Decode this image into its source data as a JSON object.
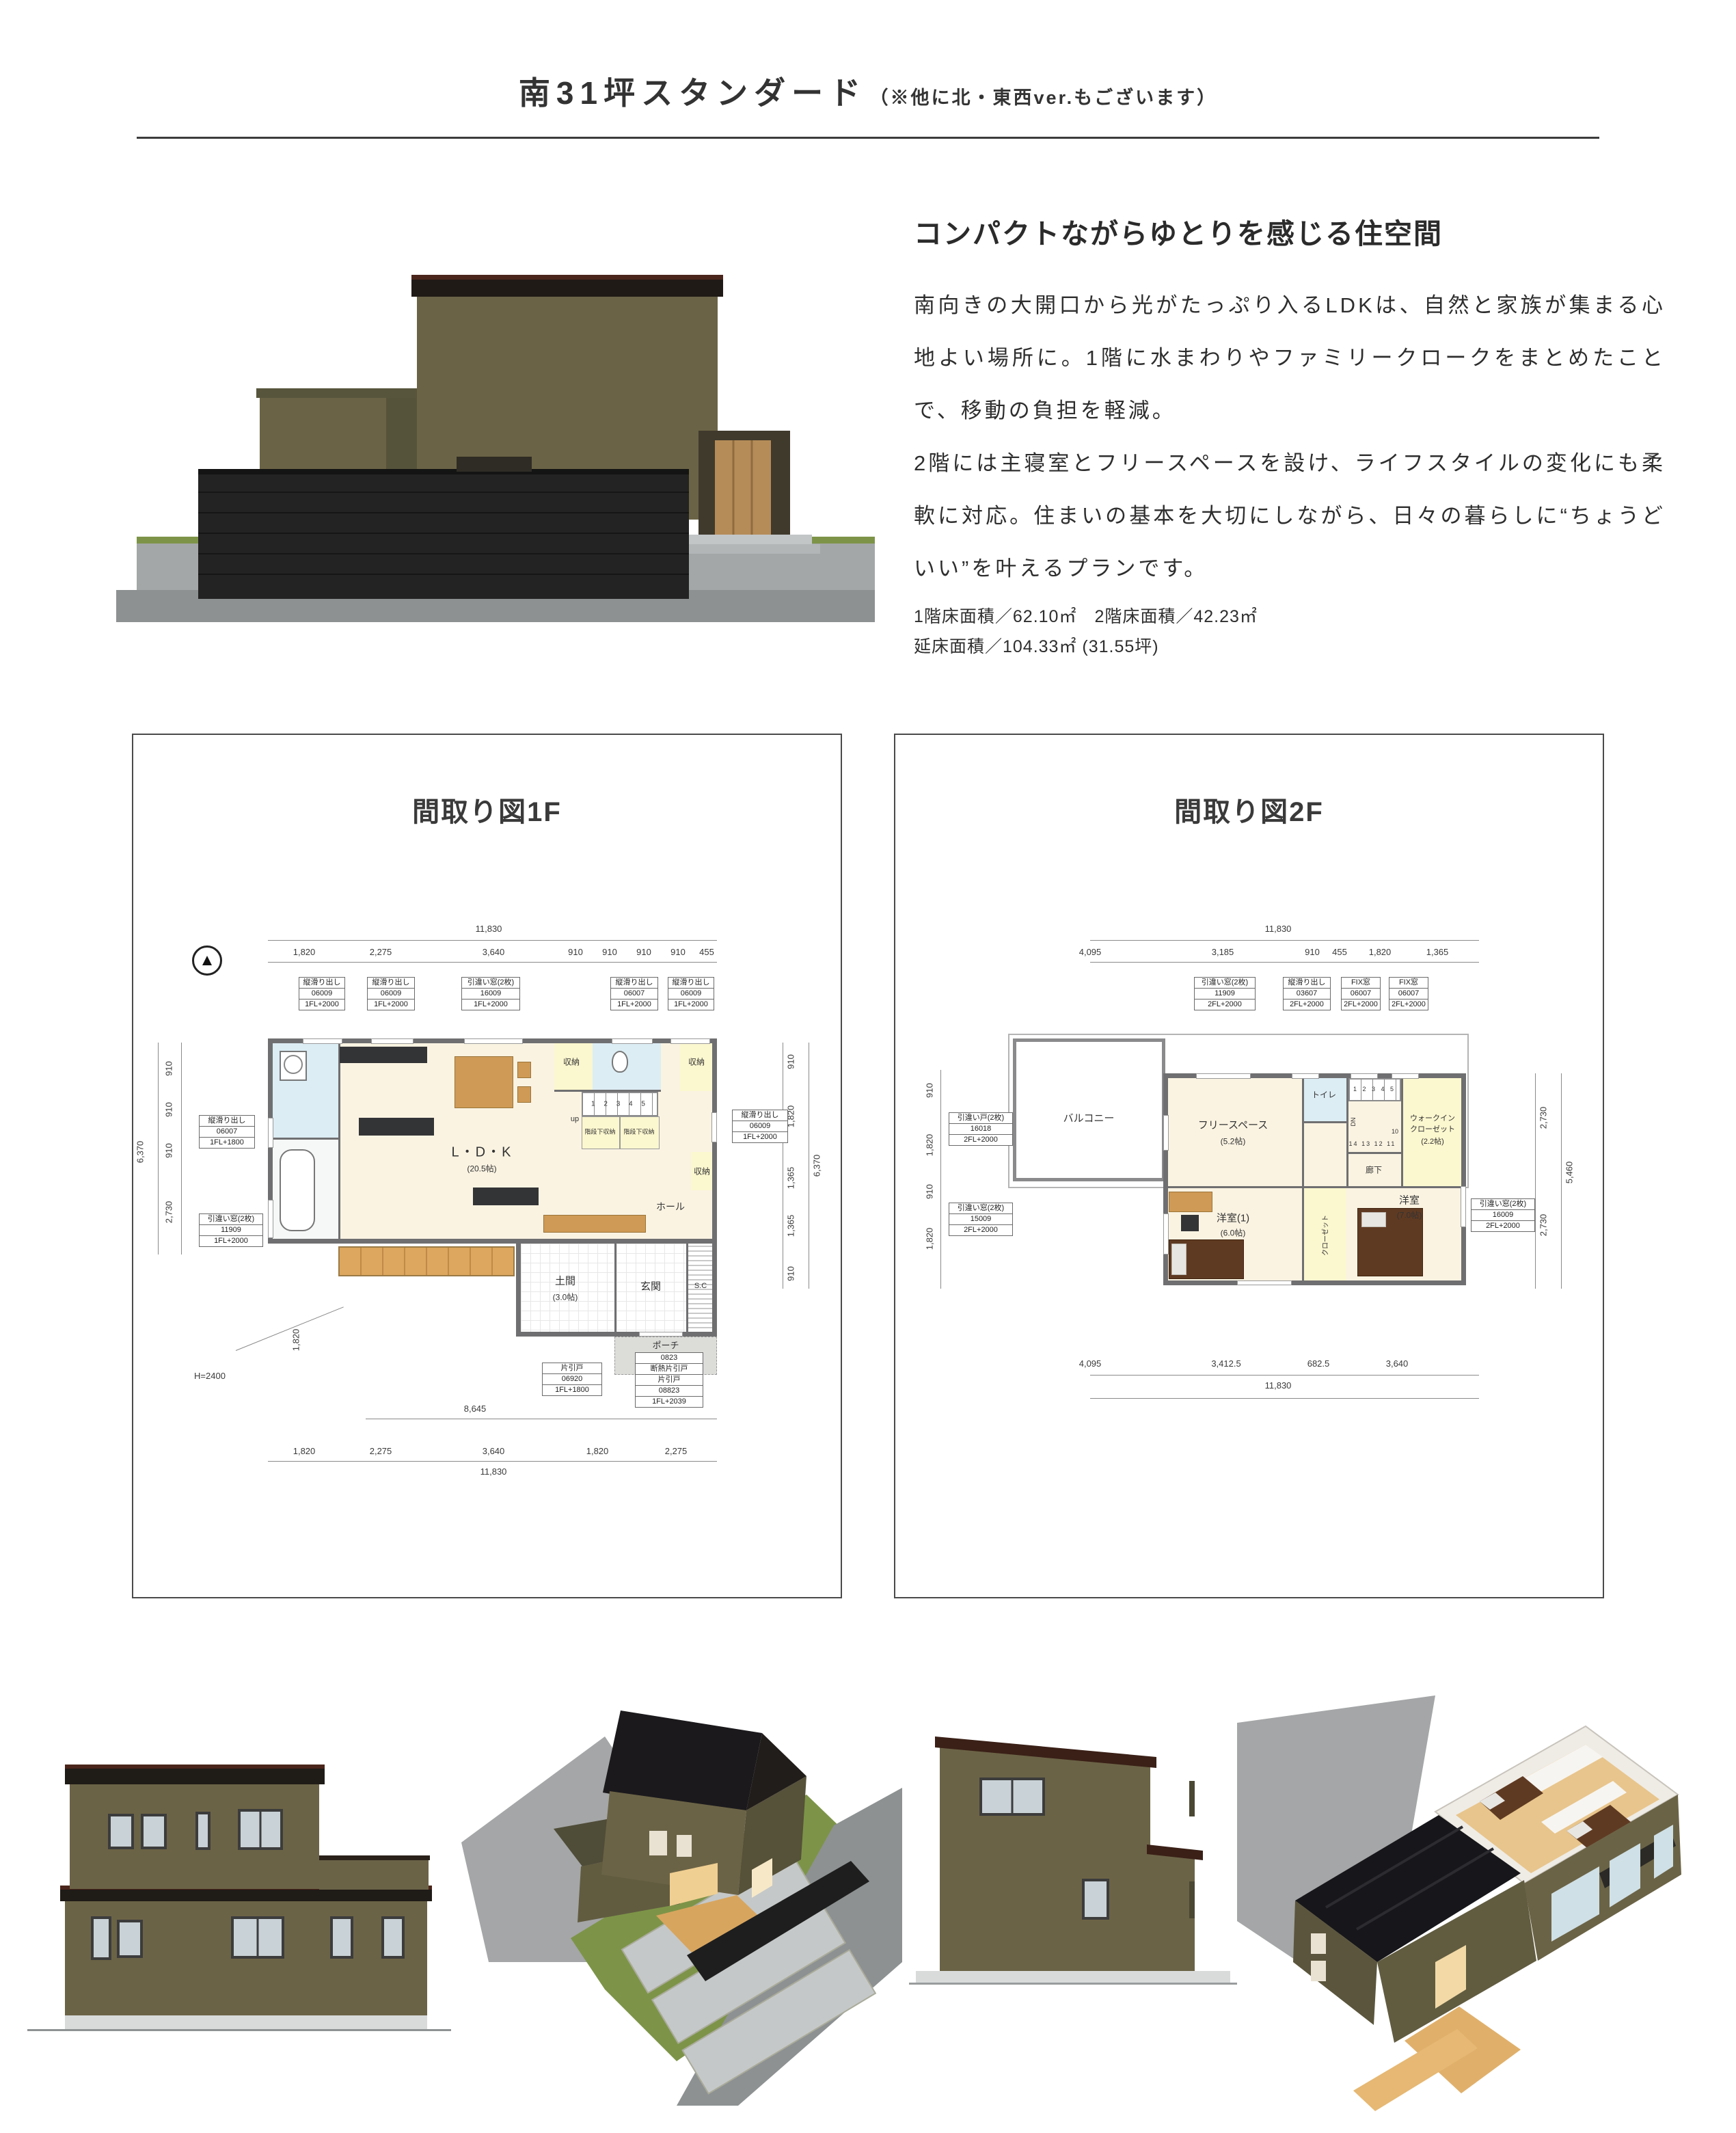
{
  "page": {
    "title": "南31坪スタンダード",
    "title_note": "（※他に北・東西ver.もございます）"
  },
  "hero": {
    "heading": "コンパクトながらゆとりを感じる住空間",
    "paragraph1": "南向きの大開口から光がたっぷり入るLDKは、自然と家族が集まる心地よい場所に。1階に水まわりやファミリークロークをまとめたことで、移動の負担を軽減。",
    "paragraph2": "2階には主寝室とフリースペースを設け、ライフスタイルの変化にも柔軟に対応。住まいの基本を大切にしながら、日々の暮らしに“ちょうどいい”を叶えるプランです。",
    "area_line1": "1階床面積／62.10㎡　2階床面積／42.23㎡",
    "area_line2": "延床面積／104.33㎡ (31.55坪)"
  },
  "plan1f": {
    "title": "間取り図1F",
    "top_total": "11,830",
    "top_dims": [
      "1,820",
      "2,275",
      "3,640",
      "910",
      "910",
      "910",
      "910",
      "455"
    ],
    "win_top": [
      {
        "l1": "縦滑り出し",
        "l2": "06009",
        "l3": "1FL+2000"
      },
      {
        "l1": "縦滑り出し",
        "l2": "06009",
        "l3": "1FL+2000"
      },
      {
        "l1": "引違い窓(2枚)",
        "l2": "16009",
        "l3": "1FL+2000"
      },
      {
        "l1": "縦滑り出し",
        "l2": "06007",
        "l3": "1FL+2000"
      },
      {
        "l1": "縦滑り出し",
        "l2": "06009",
        "l3": "1FL+2000"
      }
    ],
    "win_left": [
      {
        "l1": "縦滑り出し",
        "l2": "06007",
        "l3": "1FL+1800"
      },
      {
        "l1": "引違い窓(2枚)",
        "l2": "11909",
        "l3": "1FL+2000"
      }
    ],
    "win_right": [
      {
        "l1": "縦滑り出し",
        "l2": "06009",
        "l3": "1FL+2000"
      }
    ],
    "door_boxes": [
      {
        "rows": [
          "片引戸",
          "06920",
          "1FL+1800"
        ]
      },
      {
        "rows": [
          "0823",
          "断熱片引戸",
          "片引戸",
          "08823",
          "1FL+2039"
        ]
      }
    ],
    "rooms": {
      "ldk": "L・D・K",
      "ldk_size": "(20.5帖)",
      "storage": "収納",
      "stair_storage": "階段下収納",
      "hall": "ホール",
      "genkan": "玄関",
      "doma": "土間",
      "doma_size": "(3.0帖)",
      "sc": "S.C",
      "porch": "ポーチ"
    },
    "stairs": {
      "nums": "1 2 3 4 5",
      "up": "up"
    },
    "left_dims": [
      "910",
      "910",
      "910",
      "2,730"
    ],
    "left_total": "6,370",
    "left_lower": "1,820",
    "right_dims": [
      "910",
      "1,820",
      "1,365",
      "1,365",
      "910"
    ],
    "right_total": "6,370",
    "bottom_mid": "8,645",
    "bottom_dims": [
      "1,820",
      "2,275",
      "3,640",
      "1,820",
      "2,275"
    ],
    "bottom_total": "11,830",
    "height_note": "H=2400"
  },
  "plan2f": {
    "title": "間取り図2F",
    "top_total": "11,830",
    "top_dims": [
      "4,095",
      "3,185",
      "910",
      "455",
      "1,820",
      "1,365"
    ],
    "win_top": [
      {
        "l1": "引違い窓(2枚)",
        "l2": "11909",
        "l3": "2FL+2000"
      },
      {
        "l1": "縦滑り出し",
        "l2": "03607",
        "l3": "2FL+2000"
      },
      {
        "l1": "FIX窓",
        "l2": "06007",
        "l3": "2FL+2000"
      },
      {
        "l1": "FIX窓",
        "l2": "06007",
        "l3": "2FL+2000"
      }
    ],
    "win_left": [
      {
        "l1": "引違い戸(2枚)",
        "l2": "16018",
        "l3": "2FL+2000"
      },
      {
        "l1": "引違い窓(2枚)",
        "l2": "15009",
        "l3": "2FL+2000"
      }
    ],
    "win_right": [
      {
        "l1": "引違い窓(2枚)",
        "l2": "16009",
        "l3": "2FL+2000"
      }
    ],
    "rooms": {
      "balcony": "バルコニー",
      "free": "フリースペース",
      "free_size": "(5.2帖)",
      "toilet": "トイレ",
      "corridor": "廊下",
      "wic_l1": "ウォークイン",
      "wic_l2": "クローゼット",
      "wic_size": "(2.2帖)",
      "room1": "洋室(1)",
      "room1_size": "(6.0帖)",
      "room2": "洋室",
      "room2_size": "(7.0帖)",
      "closet": "クローゼット"
    },
    "stairs": {
      "nums_top": "1 2 3 4 5",
      "nums_bottom": "14 13 12 11",
      "num_mid": "10",
      "dn": "DN"
    },
    "left_dims": [
      "910",
      "1,820",
      "910",
      "1,820"
    ],
    "right_dims": [
      "2,730",
      "2,730"
    ],
    "right_total": "5,460",
    "bottom_dims": [
      "4,095",
      "3,412.5",
      "682.5",
      "3,640"
    ],
    "bottom_total": "11,830"
  },
  "colors": {
    "wall_olive": "#6b6346",
    "wall_olive_dark": "#565139",
    "roof_black": "#1f1b17",
    "fascia_brown": "#4a251b",
    "fence_black": "#1e1e1e",
    "door_wood": "#b58c58",
    "lawn_green": "#7d9448",
    "concrete": "#a6a9a9",
    "plan_wall_gray": "#6f6f71",
    "floor_cream": "#faf3e2",
    "floor_pale_yellow": "#fbf7cf",
    "floor_blue": "#dcedf4",
    "porch_gray": "#dcddd9",
    "wood_tan": "#cf9a55"
  }
}
